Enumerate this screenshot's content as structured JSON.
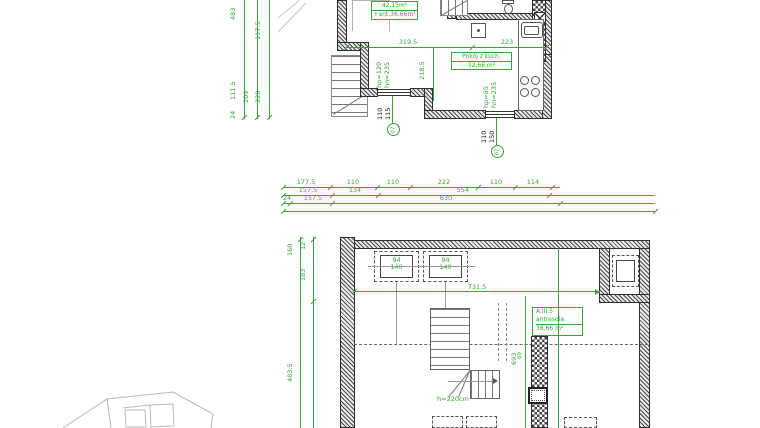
{
  "colors": {
    "dimension_green": "#3aa336",
    "wall_dark": "#3c3c3c",
    "site_gray": "#b5b5b5"
  },
  "upper_plan": {
    "area_box": {
      "line1": "42,15m²",
      "line2": "+ant.36,66m²"
    },
    "room_box": {
      "name": "Pokój z kuch.",
      "area": "32,66 m²"
    },
    "dims": {
      "width_left": "319.5",
      "width_right": "223",
      "height_mid": "218.5",
      "window1_hp": "hp=120",
      "window1_hn": "hn=235",
      "window2_hp": "hp=85",
      "window2_hn": "hn=235",
      "window1_size_w": "110",
      "window1_size_h": "115",
      "window2_size_w": "110",
      "window2_size_h": "150",
      "axis1": "07",
      "axis2": "07"
    },
    "left_chain": [
      "483",
      "117.5",
      "111.5",
      "209",
      "220",
      "24"
    ]
  },
  "dim_rows": {
    "row1": [
      "177.5",
      "110",
      "110",
      "222",
      "110",
      "114"
    ],
    "row2": [
      "157.5",
      "134",
      "554"
    ],
    "row3": [
      "24",
      "157.5",
      "630"
    ]
  },
  "lower_plan": {
    "left_chain": [
      "160",
      "12",
      "183",
      "483.5"
    ],
    "window1": {
      "w": "94",
      "h": "140"
    },
    "window2": {
      "w": "94",
      "h": "140"
    },
    "dims": {
      "width_top": "731.5",
      "height_right": "693",
      "col_left": "69",
      "col_right": "69"
    },
    "room_box": {
      "code": "A.III.5",
      "name": "antresola",
      "area": "36,66 m²"
    },
    "stair_height": "h=220cm"
  }
}
